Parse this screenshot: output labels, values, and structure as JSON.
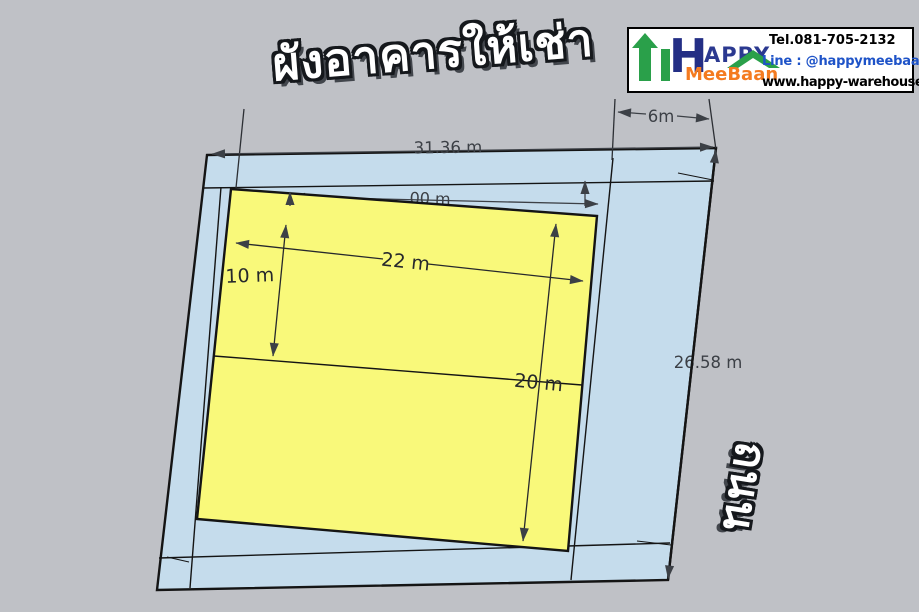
{
  "title": {
    "text": "ผังอาคารให้เช่า"
  },
  "road": {
    "text": "ถนน"
  },
  "logo": {
    "h_letter": "H",
    "happy_rest": "APPY",
    "meebaan": "MeeBaan",
    "tel": "Tel.081-705-2132",
    "line": "Line :  @happymeebaan",
    "website": "www.happy-warehouse.com",
    "colors": {
      "green": "#2aa04a",
      "navy": "#232e85",
      "happy_blue": "#2b3990",
      "orange": "#f47b20",
      "line_blue": "#1e53c8"
    }
  },
  "plan": {
    "colors": {
      "background": "#bfc1c6",
      "plot_fill": "#c5dcec",
      "building_fill": "#f9f97a",
      "outline": "#141414",
      "dim": "#3c4046"
    },
    "dims": {
      "plot_top_width": "31.36 m",
      "right_strip_width": "6m",
      "building_width": "22 m",
      "bay_depth": "10 m",
      "building_depth": "20 m",
      "plot_right_depth": "26.58 m",
      "hidden_partial": "00 m"
    }
  }
}
